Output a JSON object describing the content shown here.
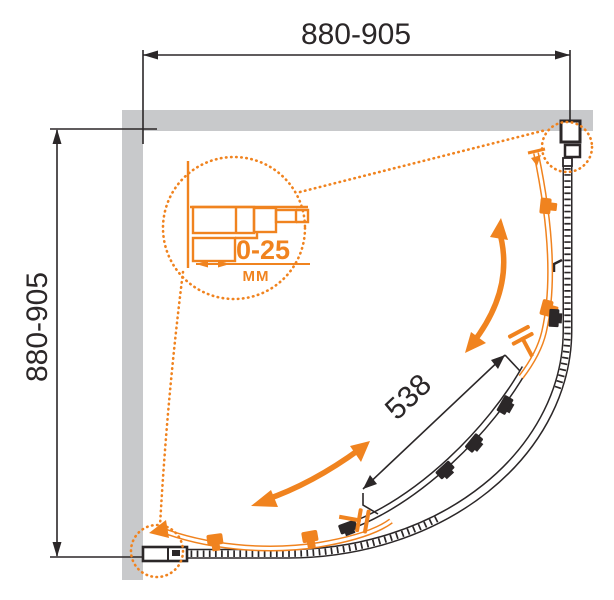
{
  "diagram": {
    "type": "shower-enclosure-dimension-drawing",
    "colors": {
      "accent_orange": "#f0831f",
      "wall_gray": "#c8c9cb",
      "line_black": "#2b2728"
    },
    "dimensions": {
      "top_width": "880-905",
      "left_height": "880-905",
      "door_chord": "538",
      "profile_adjustment": "0-25",
      "profile_adjustment_unit": "MM"
    }
  }
}
